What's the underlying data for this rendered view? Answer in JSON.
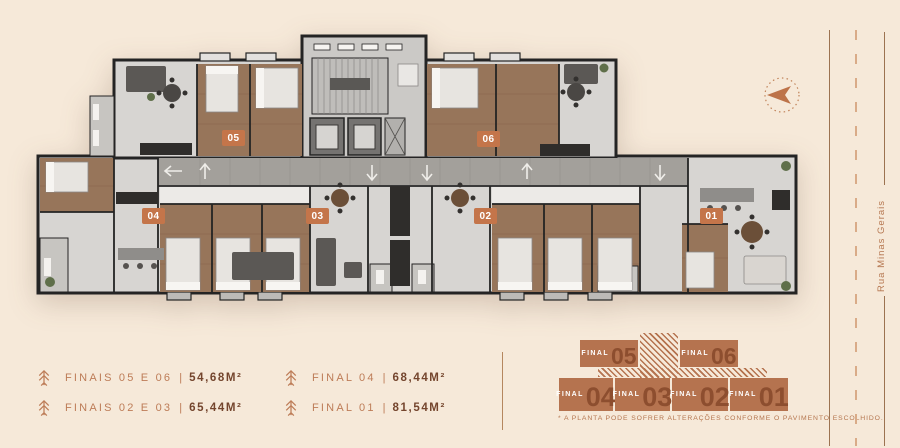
{
  "plan": {
    "units": [
      {
        "number": "05"
      },
      {
        "number": "06"
      },
      {
        "number": "04"
      },
      {
        "number": "03"
      },
      {
        "number": "02"
      },
      {
        "number": "01"
      }
    ]
  },
  "legend": {
    "separator": "|",
    "items": [
      {
        "label": "FINAIS 05 E 06",
        "area": "54,68M²"
      },
      {
        "label": "FINAIS 02 E 03",
        "area": "65,44M²"
      },
      {
        "label": "FINAL 04",
        "area": "68,44M²"
      },
      {
        "label": "FINAL 01",
        "area": "81,54M²"
      }
    ]
  },
  "keymap": {
    "top_blocks": [
      {
        "label": "FINAL",
        "number": "05"
      },
      {
        "label": "FINAL",
        "number": "06"
      }
    ],
    "bottom_blocks": [
      {
        "label": "FINAL",
        "number": "04"
      },
      {
        "label": "FINAL",
        "number": "03"
      },
      {
        "label": "FINAL",
        "number": "02"
      },
      {
        "label": "FINAL",
        "number": "01"
      }
    ],
    "disclaimer": "* A PLANTA PODE SOFRER ALTERAÇÕES CONFORME O PAVIMENTO ESCOLHIDO."
  },
  "street": {
    "name": "Rua Minas Gerais"
  },
  "colors": {
    "background": "#f6e9d9",
    "copper": "#bd7c57",
    "copper_dark": "#74452d",
    "keymap_block": "#b5734f",
    "keymap_number": "#8d4e2f",
    "unit_label_bg": "#c4754a"
  }
}
